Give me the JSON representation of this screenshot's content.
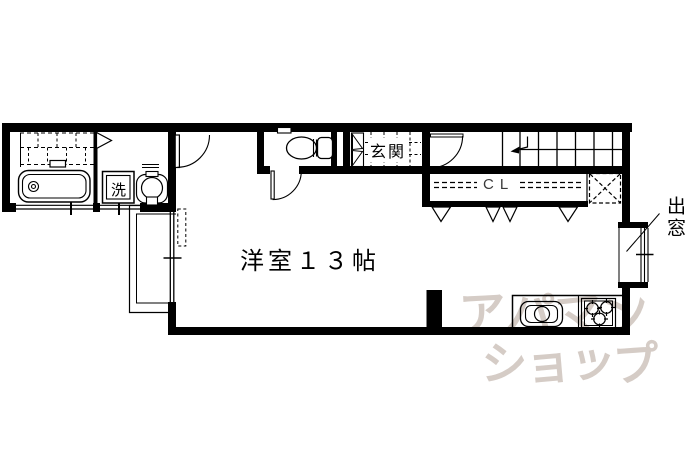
{
  "floorplan": {
    "room_label": "洋室１３帖",
    "entrance_label": "玄関",
    "washer_label": "洗",
    "closet_label": "CL",
    "bay_window_label": "出窓"
  },
  "watermark": {
    "line1": "アパマン",
    "line2": "ショップ"
  },
  "colors": {
    "line": "#000000",
    "background": "#ffffff",
    "watermark": "#d5ccc6"
  }
}
